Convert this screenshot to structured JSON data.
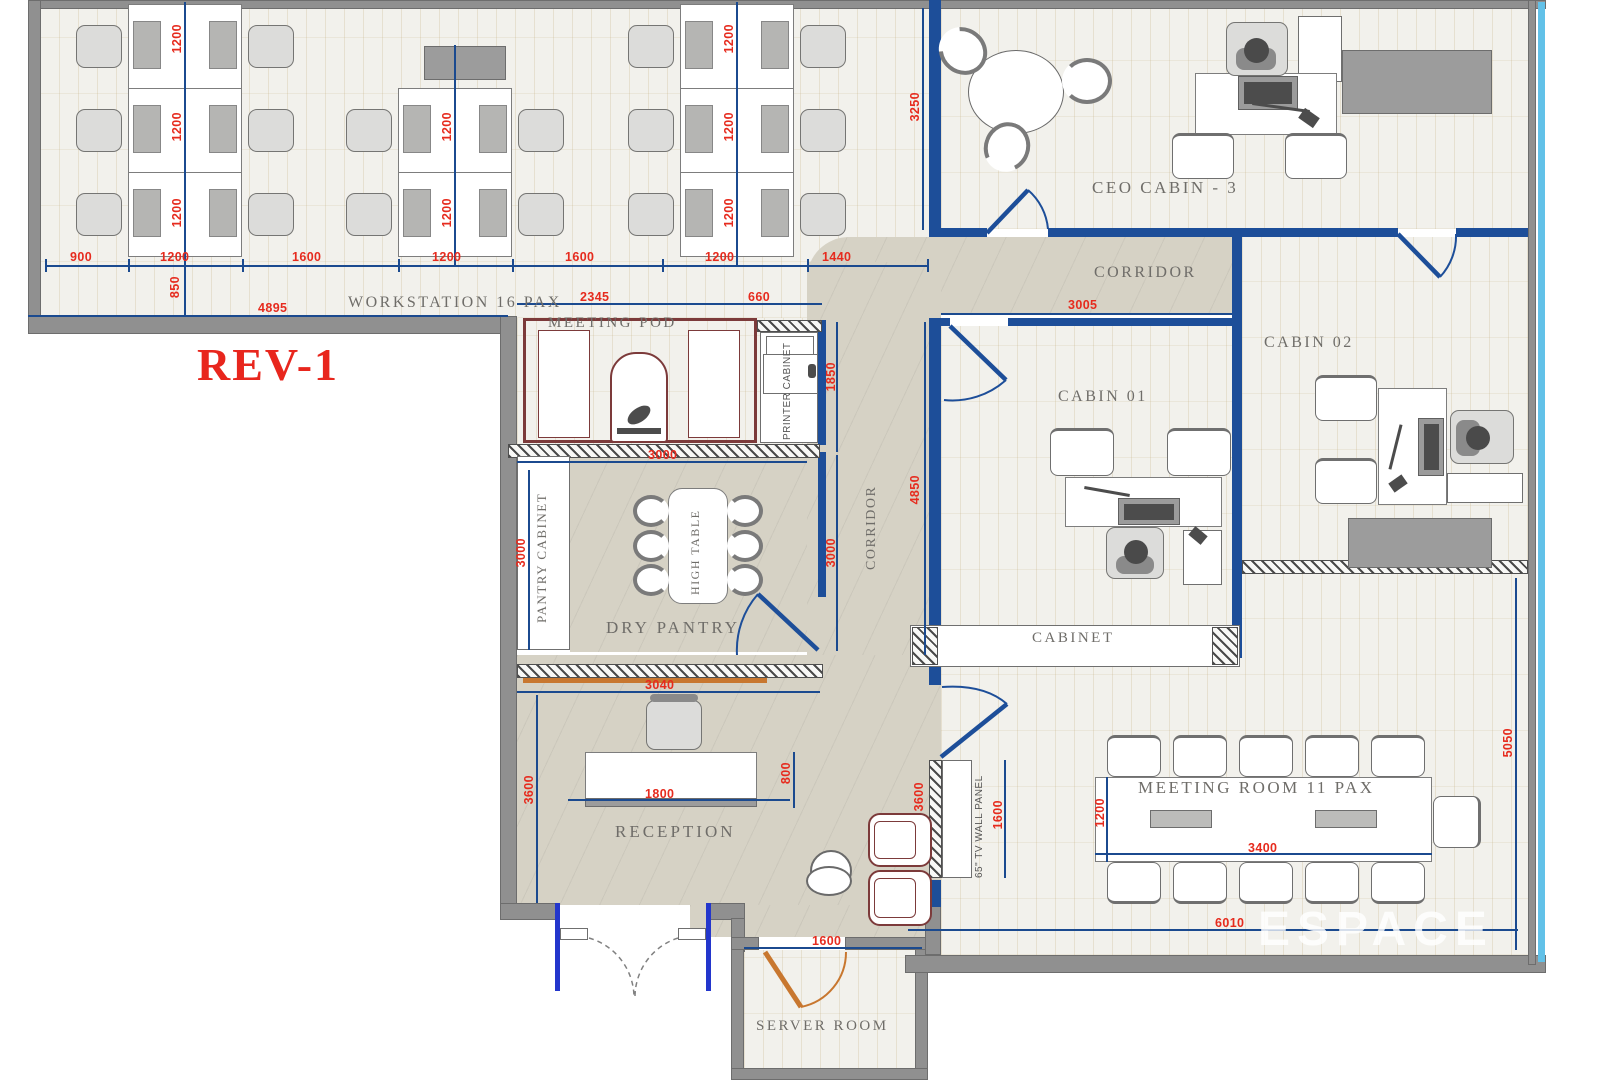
{
  "plan": {
    "revision": "REV-1",
    "watermark": "ESPACE"
  },
  "rooms": {
    "workstation": "WORKSTATION 16 PAX",
    "meeting_pod": "MEETING POD",
    "printer_cabinet": "PRINTER CABINET",
    "pantry_cabinet": "PANTRY CABINET",
    "high_table": "HIGH TABLE",
    "dry_pantry": "DRY PANTRY",
    "reception": "RECEPTION",
    "corridor_h": "CORRIDOR",
    "corridor_v": "CORRIDOR",
    "ceo_cabin": "CEO CABIN - 3",
    "cabin_01": "CABIN 01",
    "cabin_02": "CABIN 02",
    "cabinet": "CABINET",
    "meeting_room": "MEETING ROOM 11 PAX",
    "server_room": "SERVER ROOM",
    "tv_panel": "65\" TV WALL PANEL"
  },
  "dims": {
    "top_chain": [
      "900",
      "1200",
      "1600",
      "1200",
      "1600",
      "1200",
      "1440"
    ],
    "col1": [
      "1200",
      "1200",
      "1200"
    ],
    "col2": [
      "1200",
      "1200"
    ],
    "col3": [
      "1200",
      "1200",
      "1200"
    ],
    "d850": "850",
    "d4895": "4895",
    "d3250": "3250",
    "d2345": "2345",
    "d660": "660",
    "d1850": "1850",
    "d3000_top": "3000",
    "d3000_left": "3000",
    "d3000_right": "3000",
    "d3005": "3005",
    "d4850": "4850",
    "d3040": "3040",
    "d3600_reception": "3600",
    "d1800": "1800",
    "d800": "800",
    "d3600_tv": "3600",
    "d1600_tv": "1600",
    "d1200_meeting": "1200",
    "d3400": "3400",
    "d6010": "6010",
    "d5050": "5050",
    "d1600_server": "1600"
  }
}
